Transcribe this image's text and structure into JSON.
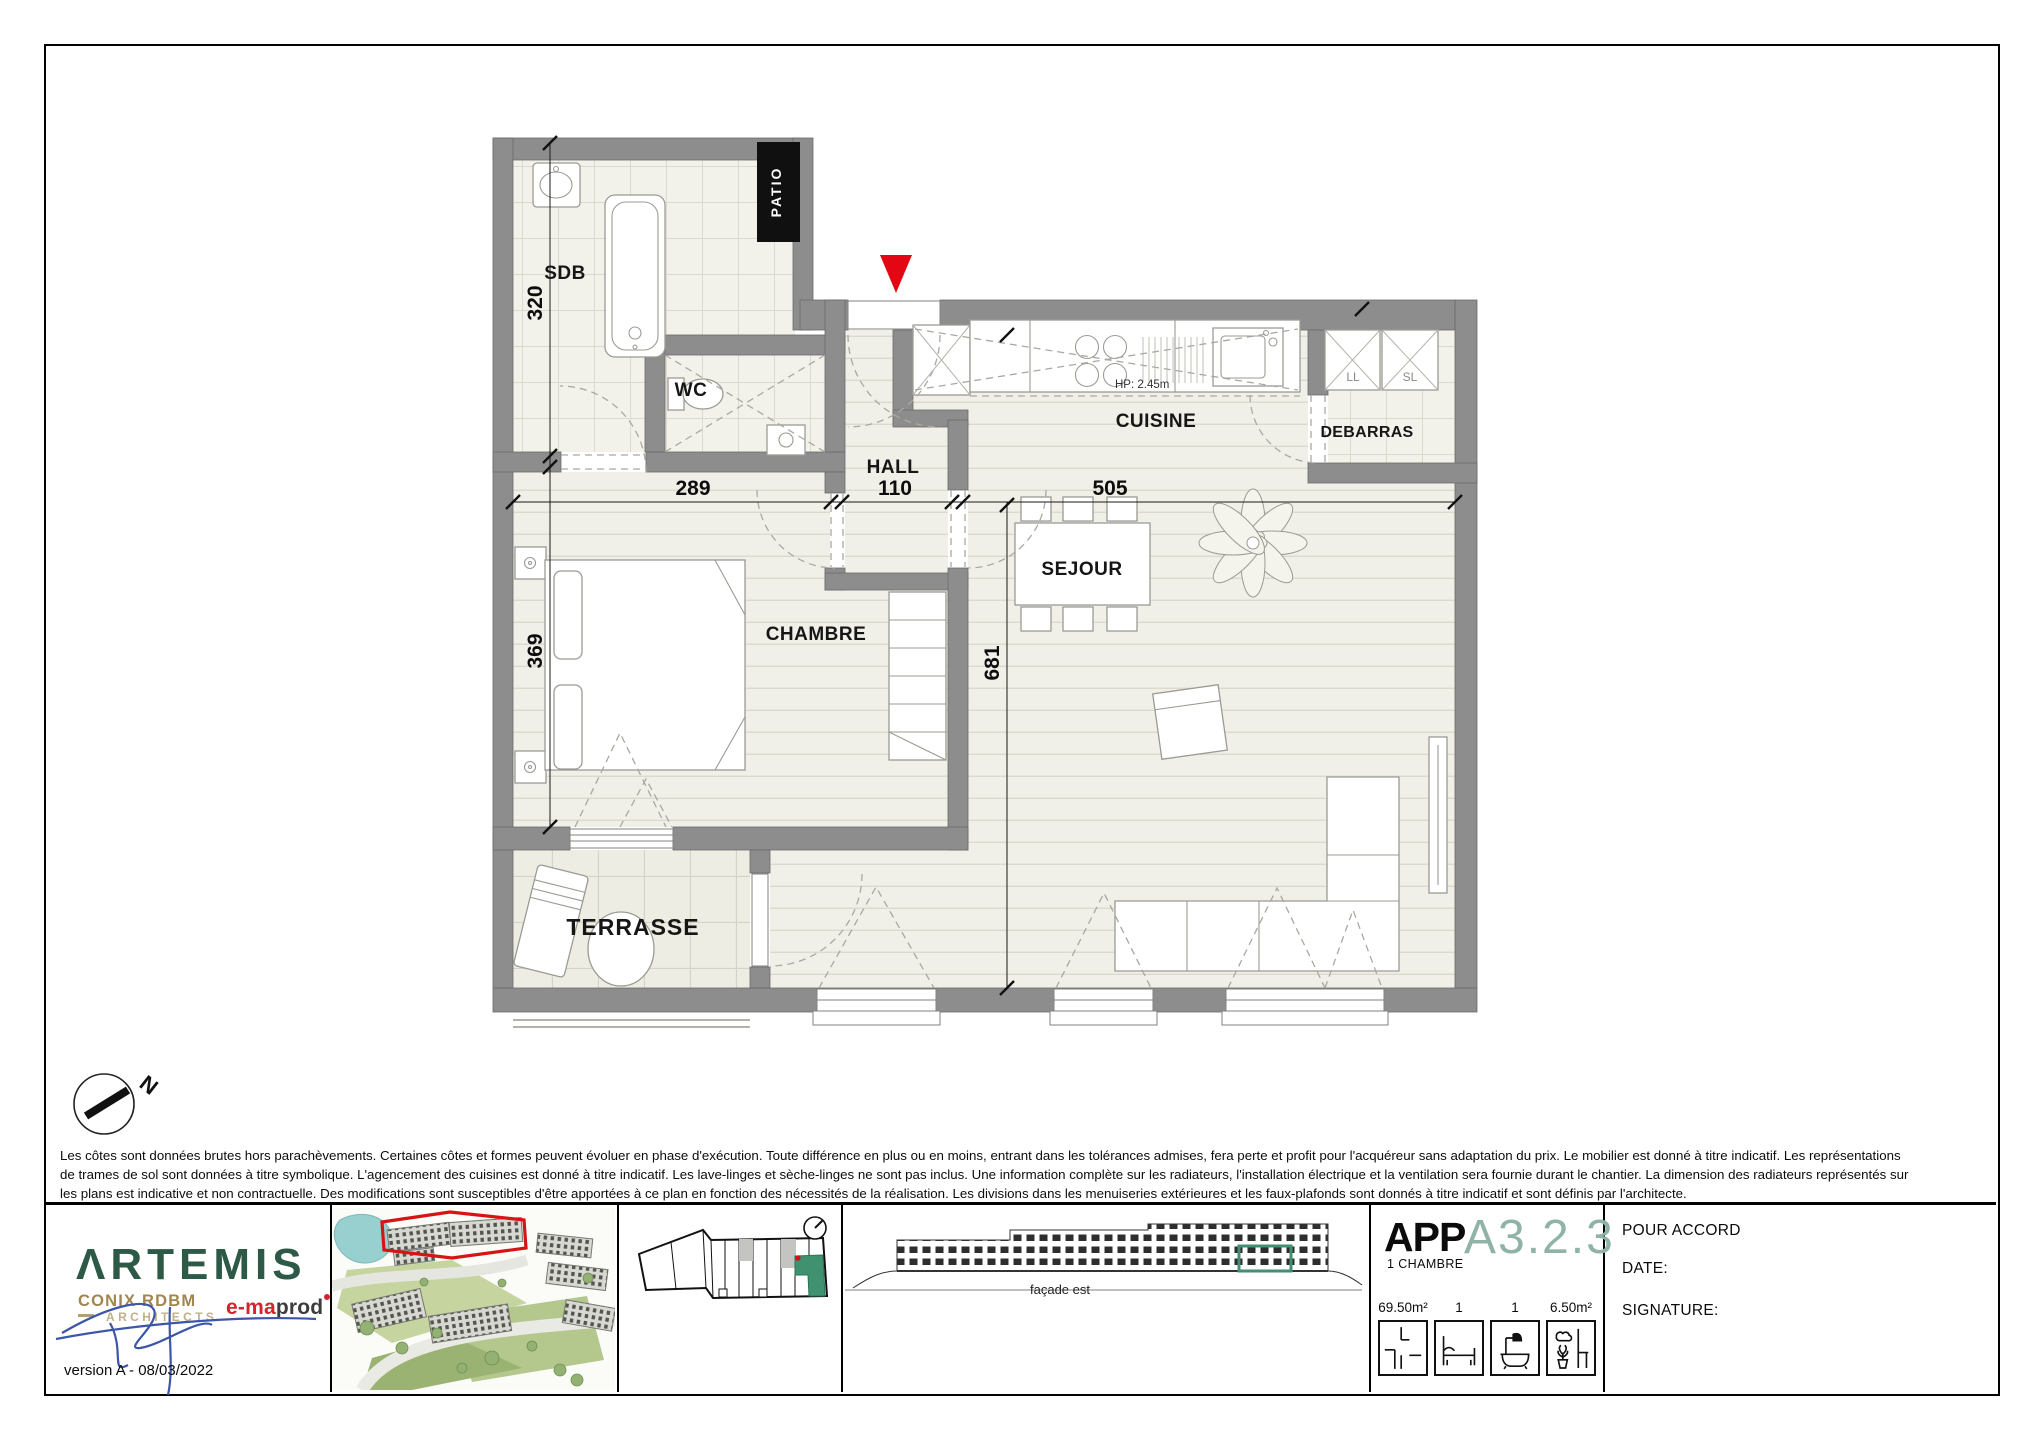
{
  "sheet": {
    "plan": {
      "rooms": {
        "sdb": "SDB",
        "wc": "WC",
        "hall": "HALL",
        "cuisine": "CUISINE",
        "debarras": "DEBARRAS",
        "sejour": "SEJOUR",
        "chambre": "CHAMBRE",
        "terrasse": "TERRASSE"
      },
      "annotations": {
        "patio": "PATIO",
        "ll": "LL",
        "sl": "SL",
        "kitchen_height": "HP: 2.45m",
        "north": "N"
      },
      "dimensions": {
        "sdb_height": "320",
        "chambre_height": "369",
        "chambre_width": "289",
        "hall_width": "110",
        "sejour_width": "505",
        "sejour_height": "681"
      }
    },
    "disclaimer": {
      "line1": "Les côtes sont données brutes hors parachèvements. Certaines côtes et formes peuvent évoluer en phase d'exécution. Toute différence en plus ou en moins, entrant dans les tolérances admises, fera perte et profit pour l'acquéreur sans adaptation du prix. Le mobilier est donné à titre indicatif. Les représentations",
      "line2": "de trames de sol sont données à titre symbolique. L'agencement des cuisines est donné à titre indicatif. Les lave-linges et sèche-linges ne sont pas inclus. Une information complète sur les radiateurs, l'installation électrique et la ventilation sera fournie durant le chantier. La dimension des radiateurs représentés sur",
      "line3": "les plans est indicative et non contractuelle. Des modifications sont susceptibles d'être apportées à ce plan en fonction des nécessités de la réalisation. Les divisions dans les menuiseries extérieures et les faux-plafonds sont donnés à titre indicatif et sont définis par l'architecte."
    },
    "footer": {
      "branding": {
        "logo": "ΛRTEMIS",
        "architect": "CONIX RDBM",
        "architect_subtitle": "ARCHITECTS",
        "partner_accent": "e-ma",
        "partner_rest": "prod",
        "version": "version A - 08/03/2022"
      },
      "elevation_caption": "façade est",
      "unit": {
        "type_label": "APP",
        "bedrooms": "1 CHAMBRE",
        "code": "A3.2.3",
        "stats": [
          {
            "icon": "floorplan-icon",
            "value": "69.50m²"
          },
          {
            "icon": "bed-icon",
            "value": "1"
          },
          {
            "icon": "bath-icon",
            "value": "1"
          },
          {
            "icon": "terrace-icon",
            "value": "6.50m²"
          }
        ]
      },
      "approval": {
        "title": "POUR ACCORD",
        "date_label": "DATE:",
        "signature_label": "SIGNATURE:"
      }
    },
    "colors": {
      "accent_red": "#e30613",
      "logo_green": "#2d5947",
      "unit_code_green": "#8fb3a5",
      "highlight_green": "#3f9170",
      "gold": "#a2854f",
      "signature_blue": "#3d56a8",
      "wall_gray": "#8d8d8d"
    }
  }
}
